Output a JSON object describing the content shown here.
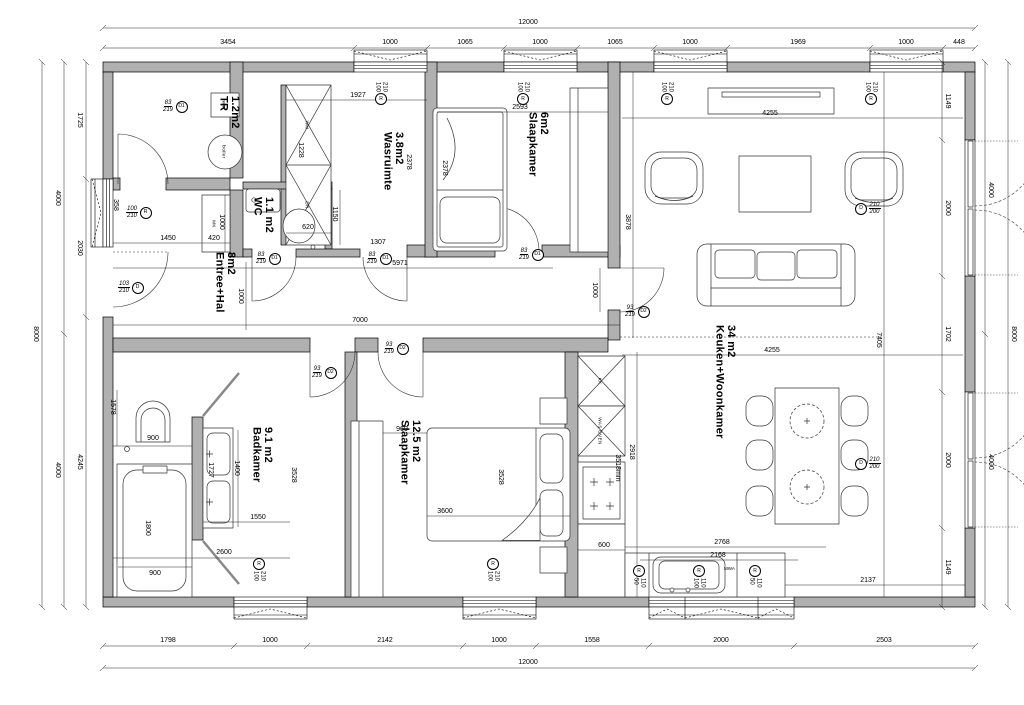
{
  "rooms": [
    {
      "name": "TR",
      "area": "1.2m2"
    },
    {
      "name": "Wasruimte",
      "area": "3.8m2"
    },
    {
      "name": "WC",
      "area": "1.1 m2"
    },
    {
      "name": "Slaapkamer",
      "area": "6m2"
    },
    {
      "name": "Entree+Hal",
      "area": "8m2"
    },
    {
      "name": "Keuken+Woonkamer",
      "area": "34 m2"
    },
    {
      "name": "Badkamer",
      "area": "9.1 m2"
    },
    {
      "name": "Slaapkamer",
      "area": "12.5 m2"
    }
  ],
  "fixtures": {
    "wtw": "wtw",
    "boiler": "boiler",
    "mk": "MK",
    "wm": "WM",
    "dr": "DR",
    "kk": "KK",
    "was_oven": "WAS OVEN",
    "mwa": "MWA"
  },
  "openings": {
    "d1": {
      "tag": "D1",
      "w": "83",
      "h": "219"
    },
    "d2": {
      "tag": "D2",
      "w": "93",
      "h": "219"
    },
    "front": {
      "tag": "D",
      "w": "103",
      "h": "210"
    },
    "french": {
      "tag": "D",
      "w": "210",
      "h": "200"
    },
    "r": {
      "tag": "R"
    },
    "w100_210": {
      "w": "100",
      "h": "210"
    },
    "w50_110": {
      "w": "50",
      "h": "110"
    },
    "w100_110": {
      "w": "100",
      "h": "110"
    }
  },
  "dims": {
    "top_total": "12000",
    "top": [
      "3454",
      "1000",
      "1065",
      "1000",
      "1065",
      "1000",
      "1969",
      "1000",
      "448"
    ],
    "bottom": [
      "1798",
      "1000",
      "2142",
      "1000",
      "1558",
      "2000",
      "2503"
    ],
    "bottom_total": "12000",
    "left_inner": [
      "1725",
      "2030",
      "4245"
    ],
    "left_mid": [
      "4000",
      "4000"
    ],
    "left_outer": "8000",
    "right_inner": [
      "1149",
      "2000",
      "1702",
      "2000",
      "1149"
    ],
    "right_mid": [
      "4000",
      "4000"
    ],
    "right_outer": "8000",
    "in": {
      "d1927": "1927",
      "d1228": "1228",
      "d620": "620",
      "d2378a": "2378",
      "d2378b": "2378",
      "d2593": "2593",
      "d3878": "3878",
      "d1150": "1150",
      "d1307": "1307",
      "d1450": "1450",
      "d420": "420",
      "d1000mk": "1000",
      "d358": "358",
      "d5971": "5971",
      "d7000": "7000",
      "d1000hal": "1000",
      "d1000liv": "1000",
      "d4255a": "4255",
      "d4255b": "4255",
      "d7405": "7405",
      "d2918": "2918",
      "d3518": "3518mm",
      "d600": "600",
      "d2768": "2768",
      "d2168": "2168",
      "d2137": "2137",
      "d1578": "1578",
      "d900a": "900",
      "d1800": "1800",
      "d900b": "900",
      "d1727": "1727",
      "d1400": "1400",
      "d1550": "1550",
      "d2600": "2600",
      "d3528a": "3528",
      "d969": "969",
      "d3600": "3600",
      "d3528b": "3528"
    }
  }
}
